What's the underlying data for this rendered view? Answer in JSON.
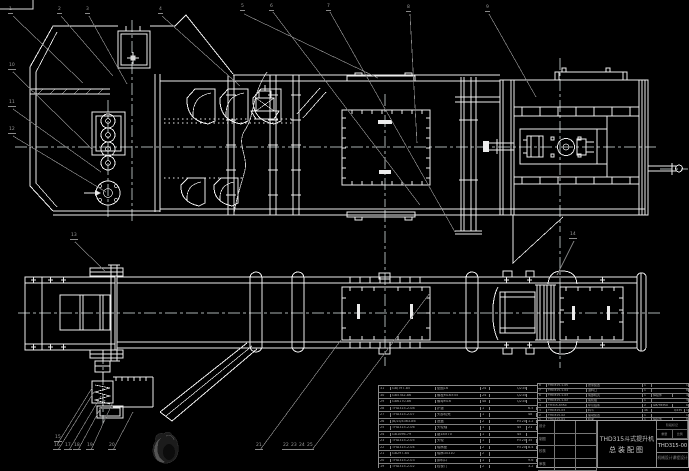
{
  "meta": {
    "background": "#000000",
    "line_color": "#ececec",
    "leader_color": "#8a8a8a",
    "table_grid_color": "#8c8c8c",
    "text_color": "#aeaeae"
  },
  "title_block": {
    "product_line1": "THD315斗式提升机",
    "product_line2": "总装配图",
    "drawing_no": "THD315-00",
    "org_line": "机械设计课程设计",
    "mark_label": "阶段标记",
    "weight_label": "重量",
    "scale_label": "比例",
    "sign_rows": [
      "设计",
      "制图",
      "校核",
      "审核"
    ]
  },
  "bom_right": {
    "headers": [
      "序号",
      "代  号",
      "名  称",
      "数量",
      "材  料",
      "重量",
      "备注"
    ],
    "rows": [
      [
        "8",
        "THD315-1-05",
        "张紧装置",
        "1",
        "",
        "",
        "12"
      ],
      [
        "7",
        "THD315-1-04",
        "进料口",
        "1",
        "",
        "",
        "8.5"
      ],
      [
        "6",
        "THD315-1-03",
        "尾部机壳",
        "1",
        "焊接件",
        "",
        "45"
      ],
      [
        "5",
        "THD315-1-02",
        "尾轮组",
        "1",
        "",
        "",
        "30"
      ],
      [
        "4",
        "TH315-8350",
        "牵引链条",
        "2",
        "GB/T8350",
        "",
        "64"
      ],
      [
        "3",
        "THD315-03",
        "料斗",
        "46",
        "",
        "Q235",
        "1.8"
      ],
      [
        "2",
        "THD315-02",
        "驱动装置",
        "1",
        "",
        "",
        "120"
      ],
      [
        "1",
        "THD315-01",
        "机架",
        "1",
        "焊接件",
        "",
        "86"
      ]
    ]
  },
  "bom_left": {
    "rows": [
      [
        "31",
        "GB/T97-85",
        "垫圈16",
        "24",
        "",
        "Q235",
        ""
      ],
      [
        "30",
        "GB5782-86",
        "螺栓M16×55",
        "24",
        "",
        "Q235",
        ""
      ],
      [
        "29",
        "GB6170-86",
        "螺母M16",
        "48",
        "",
        "Q235",
        ""
      ],
      [
        "28",
        "THD315-2-08",
        "护罩",
        "1",
        "",
        "",
        "6.5"
      ],
      [
        "27",
        "THD315-2-07",
        "头部机壳",
        "1",
        "",
        "",
        "48"
      ],
      [
        "26",
        "JB/ZQ4363-86",
        "透盖",
        "2",
        "",
        "HT200",
        "1.2"
      ],
      [
        "25",
        "THD315-2-06",
        "头轮轴",
        "1",
        "",
        "45",
        "21"
      ],
      [
        "24",
        "GB1096-79",
        "键18×70",
        "1",
        "",
        "45",
        ""
      ],
      [
        "23",
        "THD315-2-05",
        "头轮",
        "1",
        "",
        "HT200",
        "35"
      ],
      [
        "22",
        "THD315-2-04",
        "轴承座",
        "2",
        "",
        "HT200",
        "8.4"
      ],
      [
        "21",
        "GB297-84",
        "轴承30310",
        "2",
        "",
        "",
        ""
      ],
      [
        "20",
        "THD315-2-03",
        "卸料口",
        "1",
        "",
        "",
        "9.6"
      ],
      [
        "19",
        "THD315-2-02",
        "检视门",
        "2",
        "",
        "",
        "3.2"
      ],
      [
        "18",
        "THD315-2-01",
        "中部机壳",
        "4",
        "",
        "",
        "52"
      ],
      [
        "17",
        "THD315-1-06",
        "尾轮装置",
        "1",
        "",
        "",
        "26"
      ]
    ]
  },
  "balloons": [
    {
      "x": 8,
      "y": 8,
      "label": "1"
    },
    {
      "x": 57,
      "y": 8,
      "label": "2"
    },
    {
      "x": 85,
      "y": 8,
      "label": "3"
    },
    {
      "x": 158,
      "y": 8,
      "label": "4"
    },
    {
      "x": 240,
      "y": 5,
      "label": "5"
    },
    {
      "x": 269,
      "y": 5,
      "label": "6"
    },
    {
      "x": 326,
      "y": 5,
      "label": "7"
    },
    {
      "x": 406,
      "y": 6,
      "label": "8"
    },
    {
      "x": 485,
      "y": 6,
      "label": "9"
    },
    {
      "x": 8,
      "y": 64,
      "label": "10"
    },
    {
      "x": 8,
      "y": 101,
      "label": "11"
    },
    {
      "x": 8,
      "y": 128,
      "label": "12"
    },
    {
      "x": 70,
      "y": 234,
      "label": "13"
    },
    {
      "x": 569,
      "y": 233,
      "label": "14"
    },
    {
      "x": 54,
      "y": 436,
      "label": "15"
    },
    {
      "x": 53,
      "y": 444,
      "label": "16"
    },
    {
      "x": 64,
      "y": 444,
      "label": "17"
    },
    {
      "x": 73,
      "y": 444,
      "label": "18"
    },
    {
      "x": 86,
      "y": 444,
      "label": "19"
    },
    {
      "x": 108,
      "y": 444,
      "label": "20"
    },
    {
      "x": 255,
      "y": 444,
      "label": "21"
    },
    {
      "x": 282,
      "y": 444,
      "label": "22"
    },
    {
      "x": 290,
      "y": 444,
      "label": "23"
    },
    {
      "x": 298,
      "y": 444,
      "label": "24"
    },
    {
      "x": 306,
      "y": 444,
      "label": "25"
    }
  ]
}
